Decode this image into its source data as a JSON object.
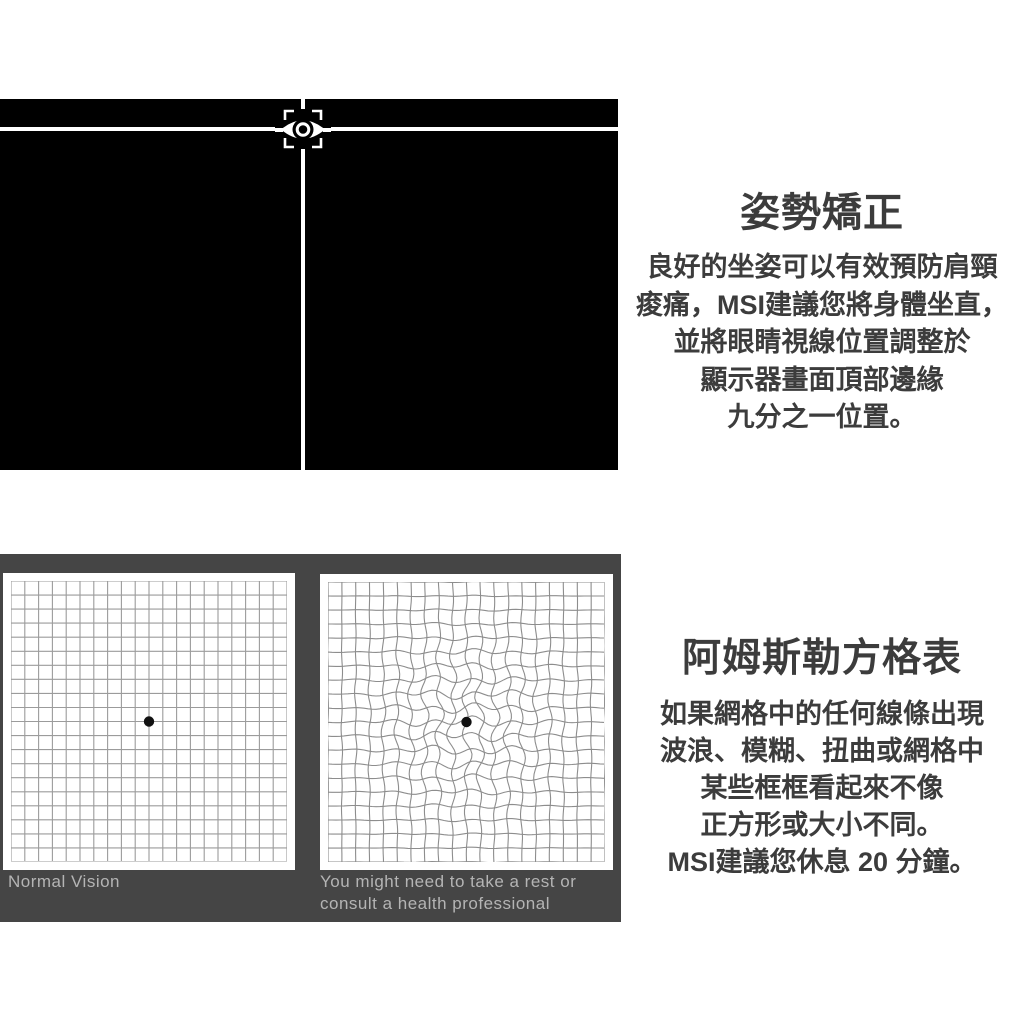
{
  "posture_section": {
    "title": "姿勢矯正",
    "body_lines": [
      "良好的坐姿可以有效預防肩頸",
      "痠痛，MSI建議您將身體坐直，",
      "並將眼睛視線位置調整於",
      "顯示器畫面頂部邊緣",
      "九分之一位置。"
    ],
    "screen_color": "#000000",
    "crosshair_color": "#ffffff",
    "icon": "eye-in-viewfinder"
  },
  "amsler_section": {
    "title": "阿姆斯勒方格表",
    "body_lines": [
      "如果網格中的任何線條出現",
      "波浪、模糊、扭曲或網格中",
      "某些框框看起來不像",
      "正方形或大小不同。",
      "MSI建議您休息 20 分鐘。"
    ],
    "container_color": "#454545",
    "label_color": "#b4b4b4",
    "panels": [
      {
        "name": "normal-amsler-grid",
        "label_lines": [
          "Normal Vision"
        ],
        "cols": 20,
        "rows": 20,
        "distorted": false,
        "line_color": "#9b9b9b",
        "dot_color": "#111111"
      },
      {
        "name": "distorted-amsler-grid",
        "label_lines": [
          "You might need to take a rest or",
          "consult a health professional"
        ],
        "cols": 20,
        "rows": 20,
        "distorted": true,
        "line_color": "#8d8d8d",
        "dot_color": "#111111"
      }
    ]
  },
  "text_color": "#3c3c3c"
}
